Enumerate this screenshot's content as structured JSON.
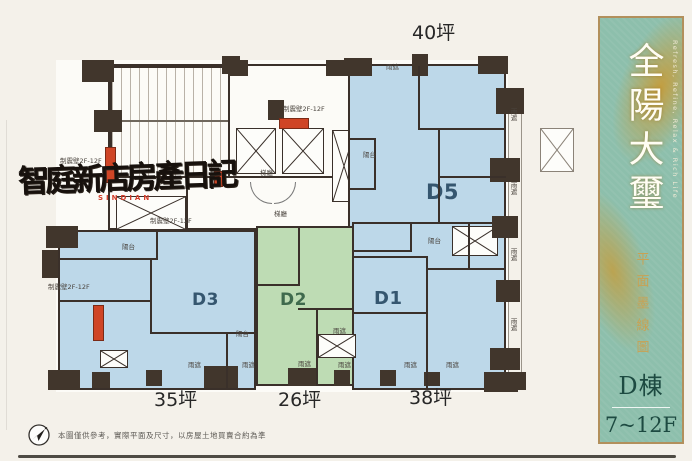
{
  "page": {
    "background": "#f4f1ea"
  },
  "sidebar": {
    "title": "全陽大璽",
    "title_en": "Refresh, Refine, Relax & Rich Life",
    "subtitle": "平面墨線圖",
    "building": "D棟",
    "floors": "7~12F",
    "colors": {
      "panel": "#8dbfac",
      "border": "#b2905c",
      "gold": "#c8a254",
      "text_dark_green": "#1d4a41"
    }
  },
  "plan": {
    "units": [
      {
        "id": "D5",
        "label": "D5",
        "area": "40坪",
        "fill": "#bdd8e9"
      },
      {
        "id": "D3",
        "label": "D3",
        "area": "35坪",
        "fill": "#bdd8e9"
      },
      {
        "id": "D2",
        "label": "D2",
        "area": "26坪",
        "fill": "#bedcb4"
      },
      {
        "id": "D1",
        "label": "D1",
        "area": "38坪",
        "fill": "#bdd8e9"
      }
    ],
    "labels": {
      "balcony": "陽台",
      "rain_shade": "雨遮",
      "damper_wall": "制震壁2F-12F",
      "elevator_lobby": "梯廳"
    },
    "colors": {
      "wall": "#3a302a",
      "damper_red": "#cf4526",
      "unit_blue": "#bdd8e9",
      "unit_green": "#bedcb4"
    }
  },
  "watermark": {
    "text": "智庭新店房產日記",
    "subtext": "SINDIAN"
  },
  "footer": {
    "disclaimer": "本圖僅供參考，實際平面及尺寸，以房屋土地買賣合約為準"
  }
}
